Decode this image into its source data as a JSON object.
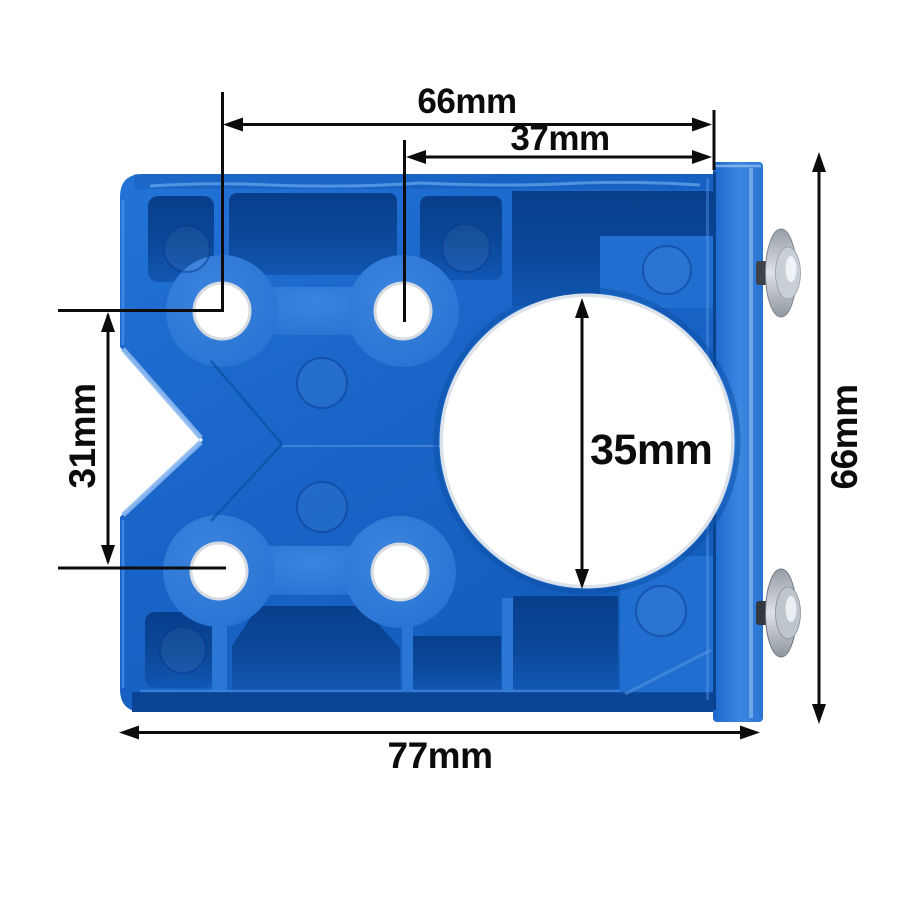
{
  "scene": {
    "description": "Product dimension diagram of a blue 35mm concealed-hinge drilling jig plate with edge fence and two screws, annotated with black dimension arrows",
    "background_color": "#ffffff",
    "colors": {
      "plate_blue": "#1a66c9",
      "plate_highlight": "#4f94e6",
      "pocket_recess": "#0b4899",
      "fence_flange": "#2d79d7",
      "annotation": "#0c0c0c",
      "hole_white": "#ffffff",
      "hole_chamfer": "#d5dbe1",
      "screw_silver": "#c9cfd6"
    }
  },
  "labels": {
    "top_width": "66mm",
    "inner_width": "37mm",
    "left_height": "31mm",
    "bore_diameter": "35mm",
    "right_height": "66mm",
    "bottom_width": "77mm"
  }
}
